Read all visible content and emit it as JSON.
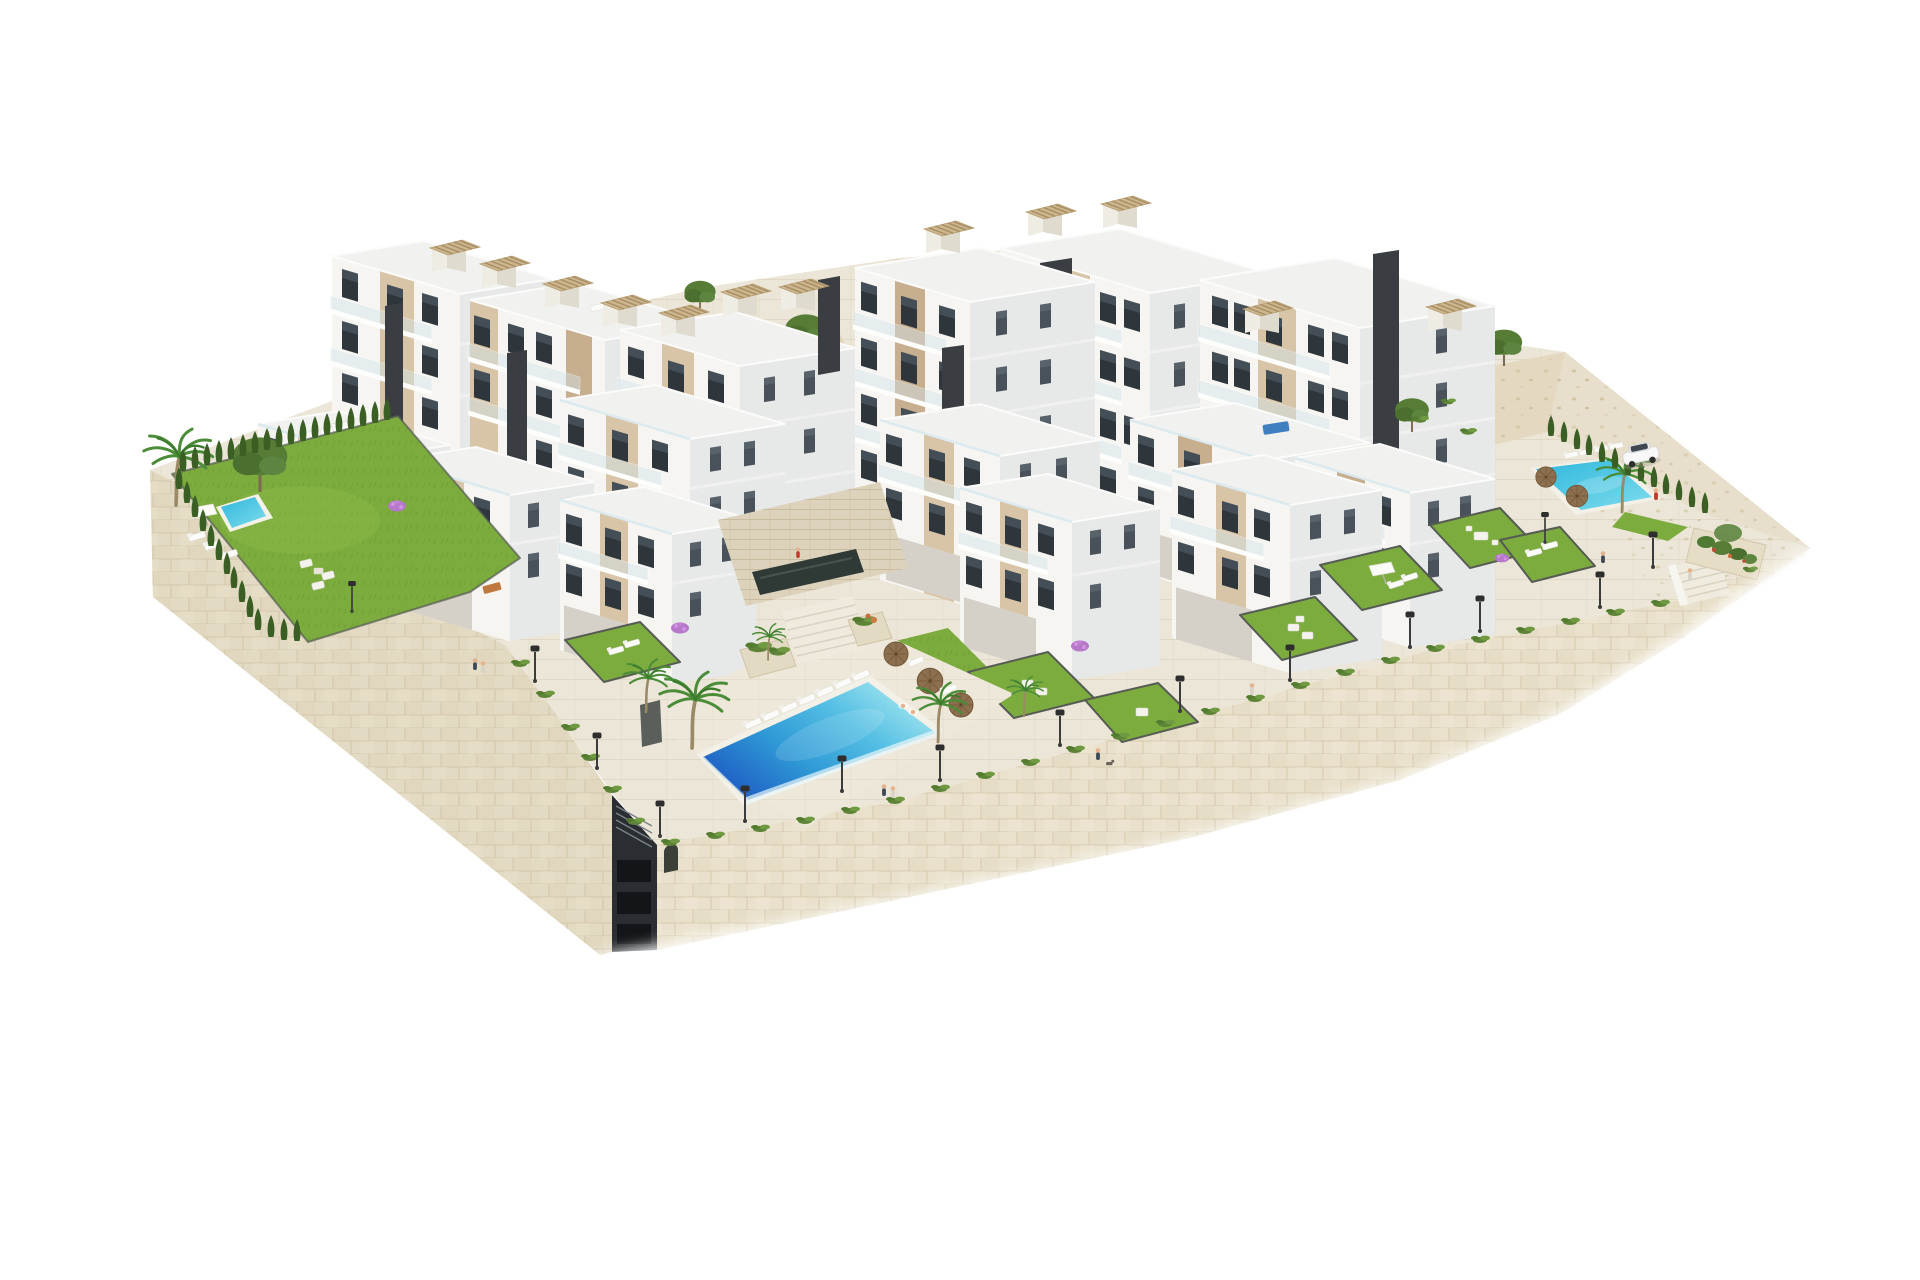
{
  "meta": {
    "type": "architectural-render",
    "description": "Aerial 3D architectural rendering of a modern white hillside residential complex: stepped apartment blocks with beige accent panels, glass balconies and rooftop pergolas, built on a podium of beige stone retaining walls, with landscaped lawns, cypress hedges, palm trees, three swimming pools, a promenade with street lamps, a white car on an upper parking terrace and small human figures, all on a plain white background.",
    "background": "#ffffff"
  },
  "palette": {
    "background": "#ffffff",
    "facade_white": "#f6f5f1",
    "facade_side": "#e7e8e8",
    "facade_recess": "#d6d1c8",
    "accent_beige": "#d8c5a8",
    "accent_beige_dark": "#c6ae8e",
    "window_dark": "#2e363c",
    "window_reflection": "#5a6670",
    "glass_railing": "#d3e4ec",
    "dark_core": "#3a3e43",
    "roof_light": "#f1f2f0",
    "stone_wall": "#e9e1cc",
    "stone_joint": "#d5c8ac",
    "paving": "#ece6d8",
    "paving_line": "#ddd4c0",
    "rocky": "#e4d9c0",
    "grass": "#7dac3e",
    "grass_light": "#8fbd4e",
    "hedge_dark": "#3a5e23",
    "shrub_green": "#547c31",
    "pool_deep": "#1c55c2",
    "pool_mid": "#2f9ad6",
    "pool_light": "#8fdcec",
    "pool_foam": "#ddf3f8",
    "pool_small": "#2fb7dc",
    "umbrella_brown": "#8b6f4e",
    "pergola_tan": "#cdb790",
    "lamp_dark": "#3b3b3b",
    "car_body": "#f8f8f8",
    "skin": "#e5b48e",
    "accent_red": "#c0392b",
    "bougainvillea": "#b678c8",
    "garage_dark": "#2a2e32"
  },
  "scene": {
    "building_blocks": 15,
    "dark_stair_cores": 6,
    "roof_pergolas": 12,
    "pools": [
      {
        "name": "main-community-pool",
        "location": "center front, infinity edge over stone wall"
      },
      {
        "name": "left-garden-pool",
        "location": "private garden, upper left"
      },
      {
        "name": "right-community-pool",
        "location": "right terrace beside parking"
      }
    ],
    "street_lamps": 15,
    "palm_trees": 5,
    "pine_trees": 5,
    "cypress_hedge_rows": 3,
    "sun_loungers": 22,
    "parasols": 7,
    "people": 11,
    "dogs": 1,
    "vehicles": [
      {
        "name": "white-suv",
        "location": "upper-right parking terrace"
      }
    ],
    "stairways": 2,
    "underground_garage_shaft": 1
  }
}
